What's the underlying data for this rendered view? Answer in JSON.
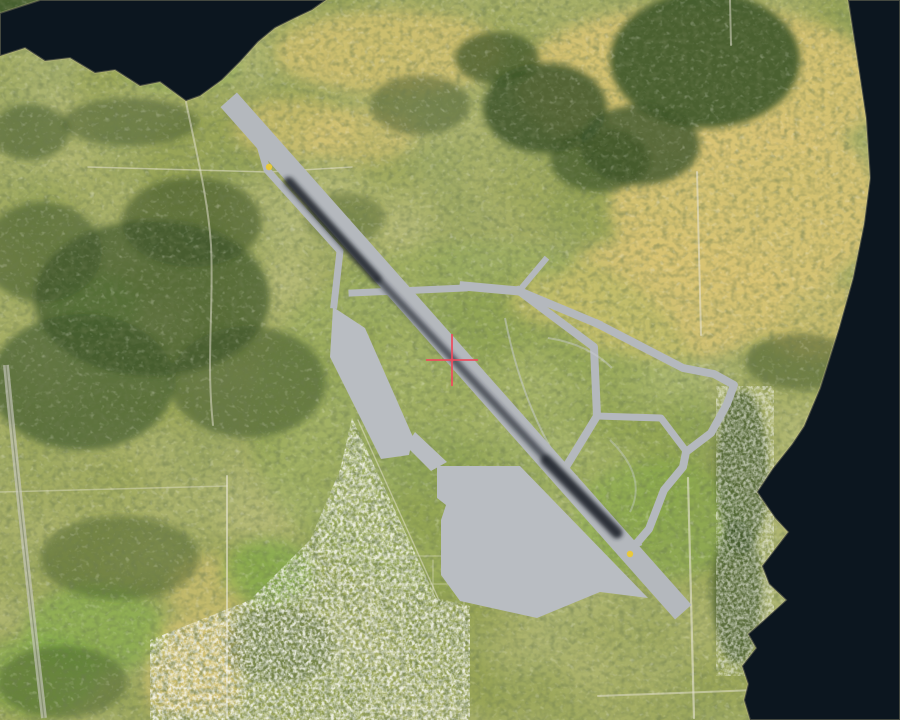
{
  "scene": {
    "type": "aerial-satellite-map",
    "width": 900,
    "height": 720,
    "description": "Aerial imagery of a coastal town with a general-aviation airfield; diagonal paved runway with dark skid marks, taxiway loop network to the east, large aprons to the southwest, dark water inlet at top-left, open water along the right edge, street-grid town at bottom-center, and a red target crosshair near image center."
  },
  "cursor": {
    "label": "target-crosshair",
    "x": 452,
    "y": 360,
    "arm_length_px": 26
  },
  "colors": {
    "water": "#0c161f",
    "land_base": "#99a557",
    "land_tan": "#d9c474",
    "field_green": "#82ae4a",
    "forest_green": "#3c5429",
    "pavement": "#b4b8bd",
    "apron": "#b9bdc2",
    "skid_marks": "#232830",
    "threshold_marker": "#e9c93a",
    "road": "#e7e4d5",
    "highway": "#c9c9c0",
    "faint_track": "#c9cdd1",
    "shoreline": "#c8bd8a",
    "crosshair": "#ee4a5c"
  },
  "features": {
    "bay": "dark water inlet, top-left",
    "sound": "open dark water along right edge, widening toward bottom",
    "airfield": "airfield with NW-SE runway crossing image center",
    "runway": "light gray runway with dark tire skid marks and yellow threshold dots at both ends",
    "taxiways": "irregular taxiway loop network east of the runway",
    "aprons": "large stepped gray aprons southwest of the lower runway",
    "town": "dense street-grid residential town, bottom-center",
    "highway": "light highway band along lower-left edge",
    "fields": "tan dry-grass fields (upper right, lower left) and bright green pastures",
    "forest": "dark conifer forest patches (top-right, center-left, coastal strip)"
  }
}
